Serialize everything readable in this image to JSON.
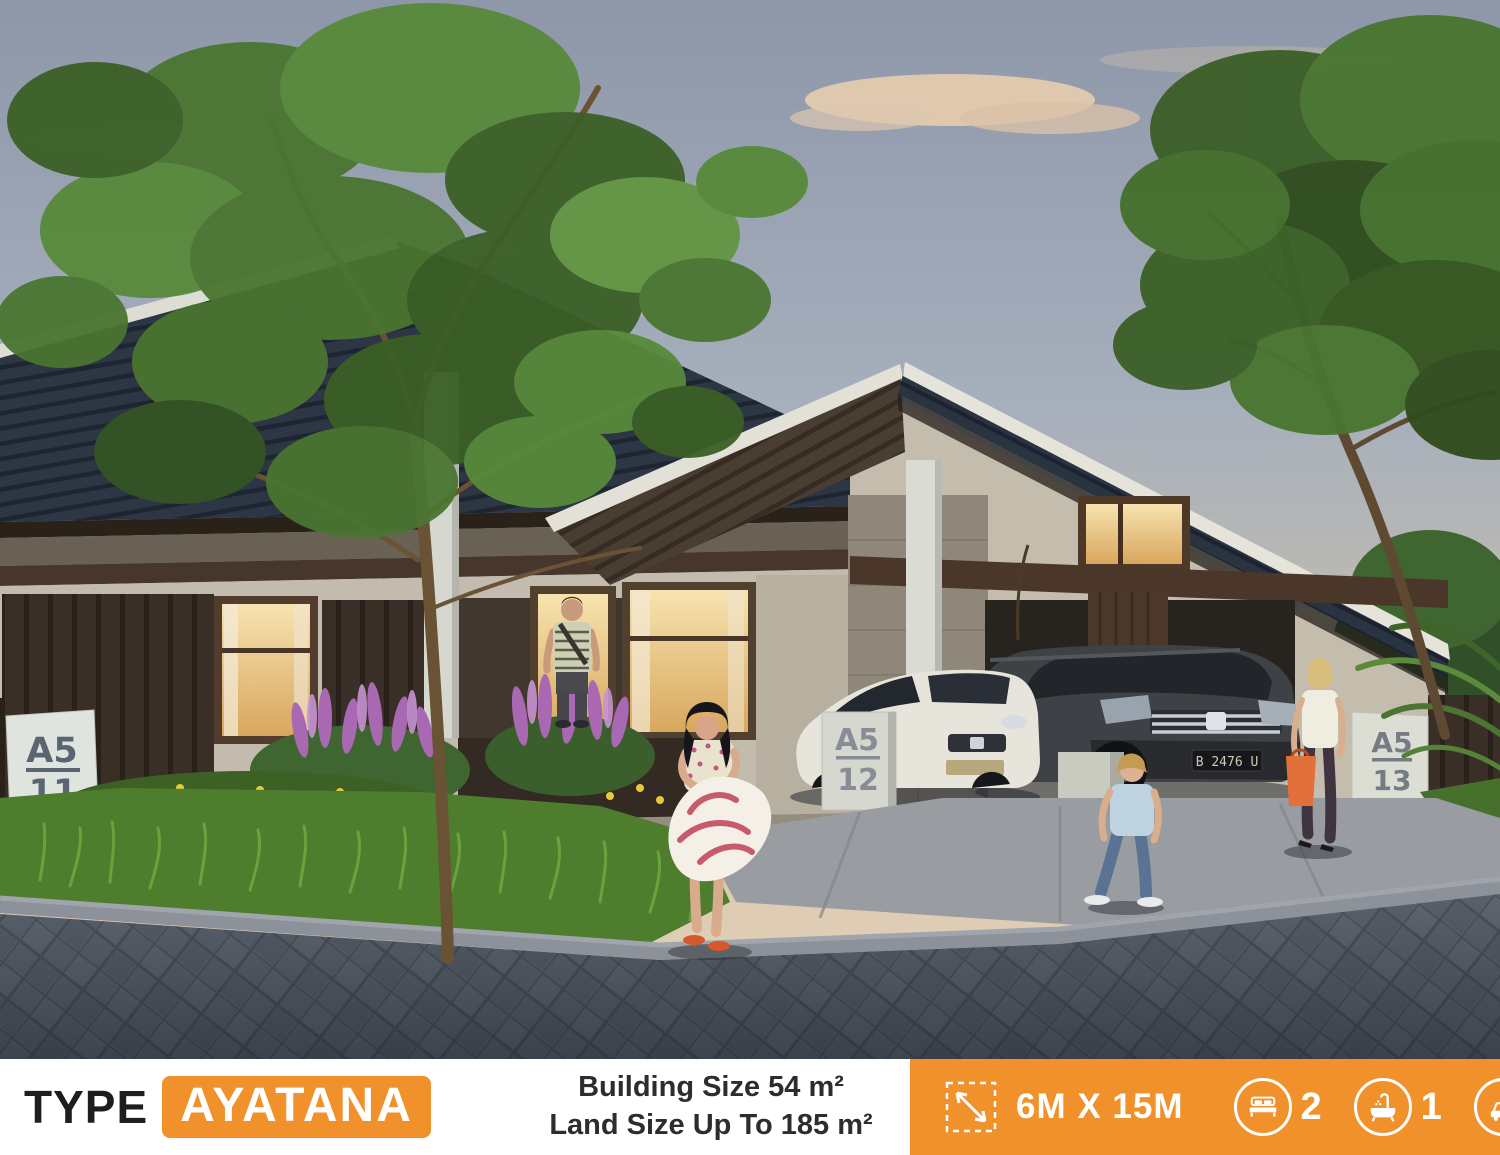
{
  "banner": {
    "type_label": "TYPE",
    "type_name": "AYATANA",
    "building_size": "Building Size 54 m²",
    "land_size": "Land Size Up To 185 m²",
    "specs": {
      "dimension_label": "6M X 15M",
      "bedrooms": "2",
      "bathrooms": "1",
      "garage": "1"
    },
    "colors": {
      "orange": "#F0912C",
      "text_dark": "#1E1E1E",
      "white": "#FFFFFF"
    }
  },
  "scene": {
    "signs": [
      {
        "block": "A5",
        "number": "11"
      },
      {
        "block": "A5",
        "number": "12"
      },
      {
        "block": "A5",
        "number": "13"
      }
    ],
    "suv_plate": "B 2476 U",
    "icons": {
      "dimension": "dimension-arrow-icon",
      "bed": "bed-icon",
      "bath": "bath-icon",
      "car": "car-icon"
    },
    "colors": {
      "sky_top": "#8D97A9",
      "sky_horizon": "#E6D4BB",
      "roof_slate": "#2D3644",
      "roof_brown": "#4A3E33",
      "wall_cream": "#C4BDAE",
      "wood_dark": "#3A2F27",
      "grass": "#4E7D2E",
      "road": "#59616C",
      "flower_purple": "#A869B2",
      "flower_yellow": "#E8C93E"
    }
  }
}
